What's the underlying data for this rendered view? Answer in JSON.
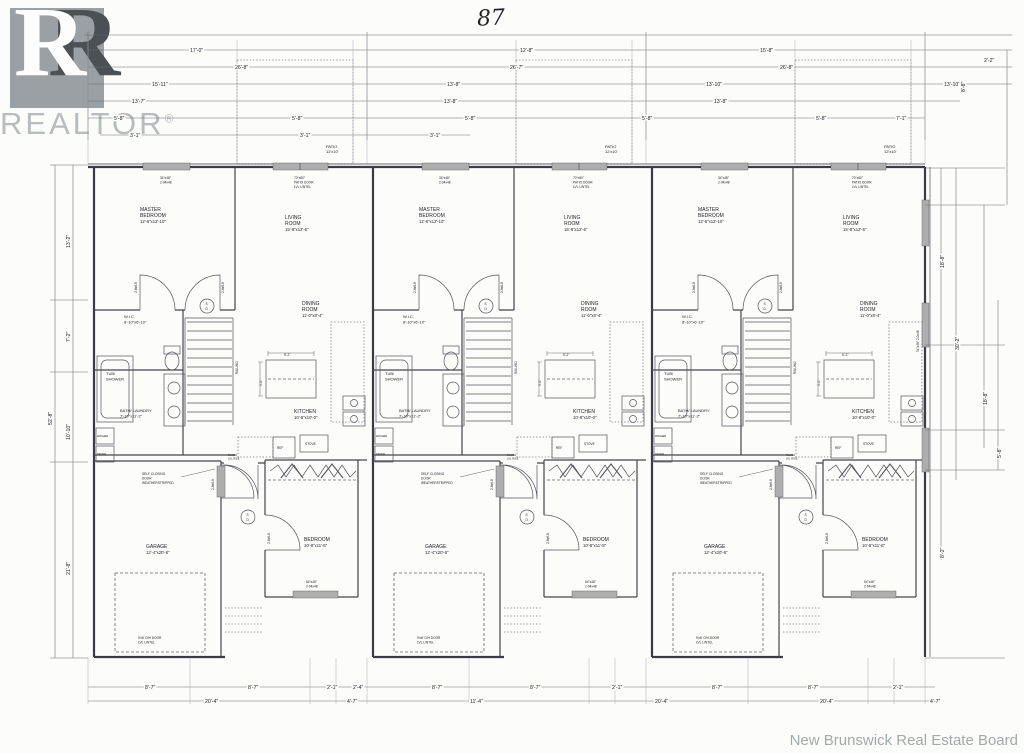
{
  "watermark": {
    "brand": "REALTOR",
    "reg": "®",
    "letter": "R"
  },
  "sheet": {
    "number": "87",
    "attribution": "New Brunswick Real Estate Board"
  },
  "unit": {
    "patio": {
      "label": "PATIO",
      "dim": "12'x10'"
    },
    "master": {
      "l1": "MASTER",
      "l2": "BEDROOM",
      "dim": "12'-6\"x12'-10\""
    },
    "living": {
      "l1": "LIVING",
      "l2": "ROOM",
      "dim": "15'-8\"x12'-6\""
    },
    "dining": {
      "l1": "DINING",
      "l2": "ROOM",
      "dim": "11'-0\"x8'-4\""
    },
    "kitchen": {
      "l1": "KITCHEN",
      "dim": "10'-8\"x10'-0\""
    },
    "wic": {
      "l1": "W.I.C.",
      "dim": "8'-10\"x6'-10\""
    },
    "tub": {
      "l1": "TUB/",
      "l2": "SHOWER"
    },
    "bath": {
      "l1": "BATH/ LAUNDRY",
      "dim": "7'-10\"x11'-2\""
    },
    "garage": {
      "l1": "GARAGE",
      "dim": "12'-4\"x20'-8\""
    },
    "bedroom": {
      "l1": "BEDROOM",
      "dim": "10'-8\"x11'-8\""
    },
    "master_window": {
      "l1": "34\"x48\"",
      "l2": "2-04x48"
    },
    "patio_door": {
      "l1": "70\"x80\"",
      "l2": "PATIO DOOR",
      "l3": "LVL LINTEL"
    },
    "bedroom_window": {
      "l1": "54\"x48\"",
      "l2": "2-04x48"
    },
    "oh_door": {
      "l1": "9'x8' O/H DOOR",
      "l2": "LVL LINTEL"
    },
    "self_closing": {
      "l1": "SELF CLOSING",
      "l2": "DOOR",
      "l3": "WEATHERSTRIPPED"
    },
    "flush": {
      "l1": "FLUSH",
      "l2": "LVL RISE"
    },
    "railing": "RAILING",
    "ref": "REF",
    "stove": "STOVE",
    "washer": "WASHER",
    "dryer": "DRYER",
    "island": {
      "w": "5'-2\"",
      "h": "3'-0\""
    },
    "smoke": {
      "s": "S",
      "d": "D"
    },
    "door_label": "2-8x6-8",
    "door_label_sm": "2-6x6-8"
  },
  "dims": {
    "top1": [
      "17'-0\"",
      "12'-8\"",
      "15'-8\"",
      "2'-2\""
    ],
    "top2": [
      "26'-8\"",
      "26'-7\"",
      "26'-8\""
    ],
    "top3": [
      "15'-11\"",
      "13'-8\"",
      "13'-10\"",
      "13'-10\""
    ],
    "top4": [
      "13'-7\"",
      "13'-8\"",
      "13'-8\""
    ],
    "top5": [
      "5'-8\"",
      "5'-8\"",
      "5'-8\"",
      "5'-8\"",
      "5'-8\"",
      "7'-1\""
    ],
    "top6": [
      "3'-1\"",
      "3'-1\"",
      "3'-1\""
    ],
    "bottom1": [
      "8'-7\"",
      "8'-7\"",
      "2'-1\"",
      "2'-4\"",
      "8'-7\"",
      "8'-7\"",
      "2'-1\"",
      "8'-7\"",
      "8'-7\"",
      "2'-1\""
    ],
    "bottom2": [
      "20'-4\"",
      "4'-7\"",
      "11'-4\"",
      "20'-4\"",
      "20'-4\"",
      "4'-7\""
    ],
    "left_outer": "52'-8\"",
    "left_inner": [
      "13'-2\"",
      "7'-2\"",
      "10'-10\"",
      "21'-8\""
    ],
    "right": [
      "8'-8\"",
      "18'-8\"",
      "30'-2\"",
      "18'-8\"",
      "5'-8\"",
      "8'-2\""
    ],
    "right_window": "34\"x48\" 2-0x48"
  }
}
